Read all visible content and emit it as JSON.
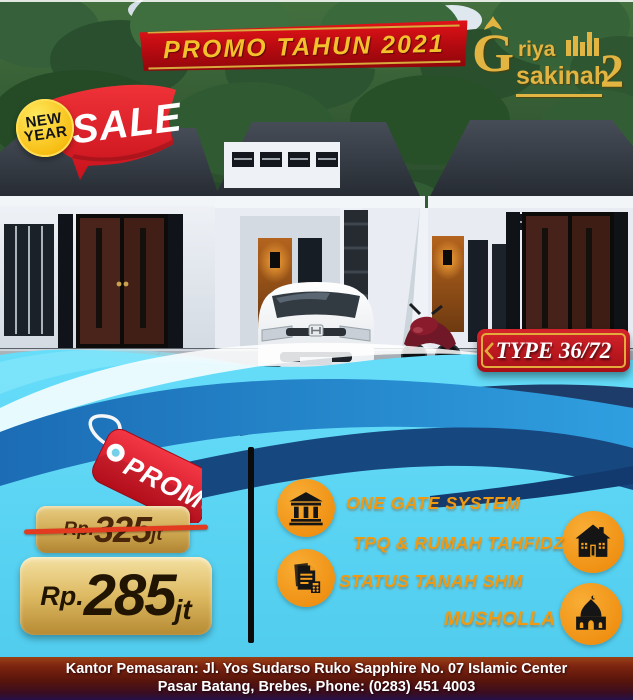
{
  "header": {
    "banner": "PROMO TAHUN 2021"
  },
  "logo": {
    "initial": "G",
    "part1": "riya",
    "part2": "sakinah",
    "number": "2"
  },
  "sale": {
    "circle_line1": "NEW",
    "circle_line2": "YEAR",
    "label": "SALE"
  },
  "type_badge": {
    "label": "TYPE 36/72"
  },
  "promo_tag": {
    "label": "PROMO"
  },
  "pricing": {
    "old": {
      "currency": "Rp.",
      "amount": "325",
      "unit": "jt"
    },
    "new": {
      "currency": "Rp.",
      "amount": "285",
      "unit": "jt"
    }
  },
  "features": [
    {
      "label": "ONE GATE SYSTEM"
    },
    {
      "label": "TPQ & RUMAH TAHFIDZ"
    },
    {
      "label": "STATUS TANAH SHM"
    },
    {
      "label": "MUSHOLLA"
    }
  ],
  "footer": {
    "line1": "Kantor Pemasaran: Jl. Yos Sudarso Ruko Sapphire No. 07 Islamic Center",
    "line2": "Pasar Batang, Brebes, Phone: (0283) 451 4003"
  },
  "colors": {
    "accent_red": "#c8121c",
    "gold": "#e2b441",
    "cyan": "#5bd8f7",
    "orange": "#f09a12",
    "navy": "#16437c"
  }
}
